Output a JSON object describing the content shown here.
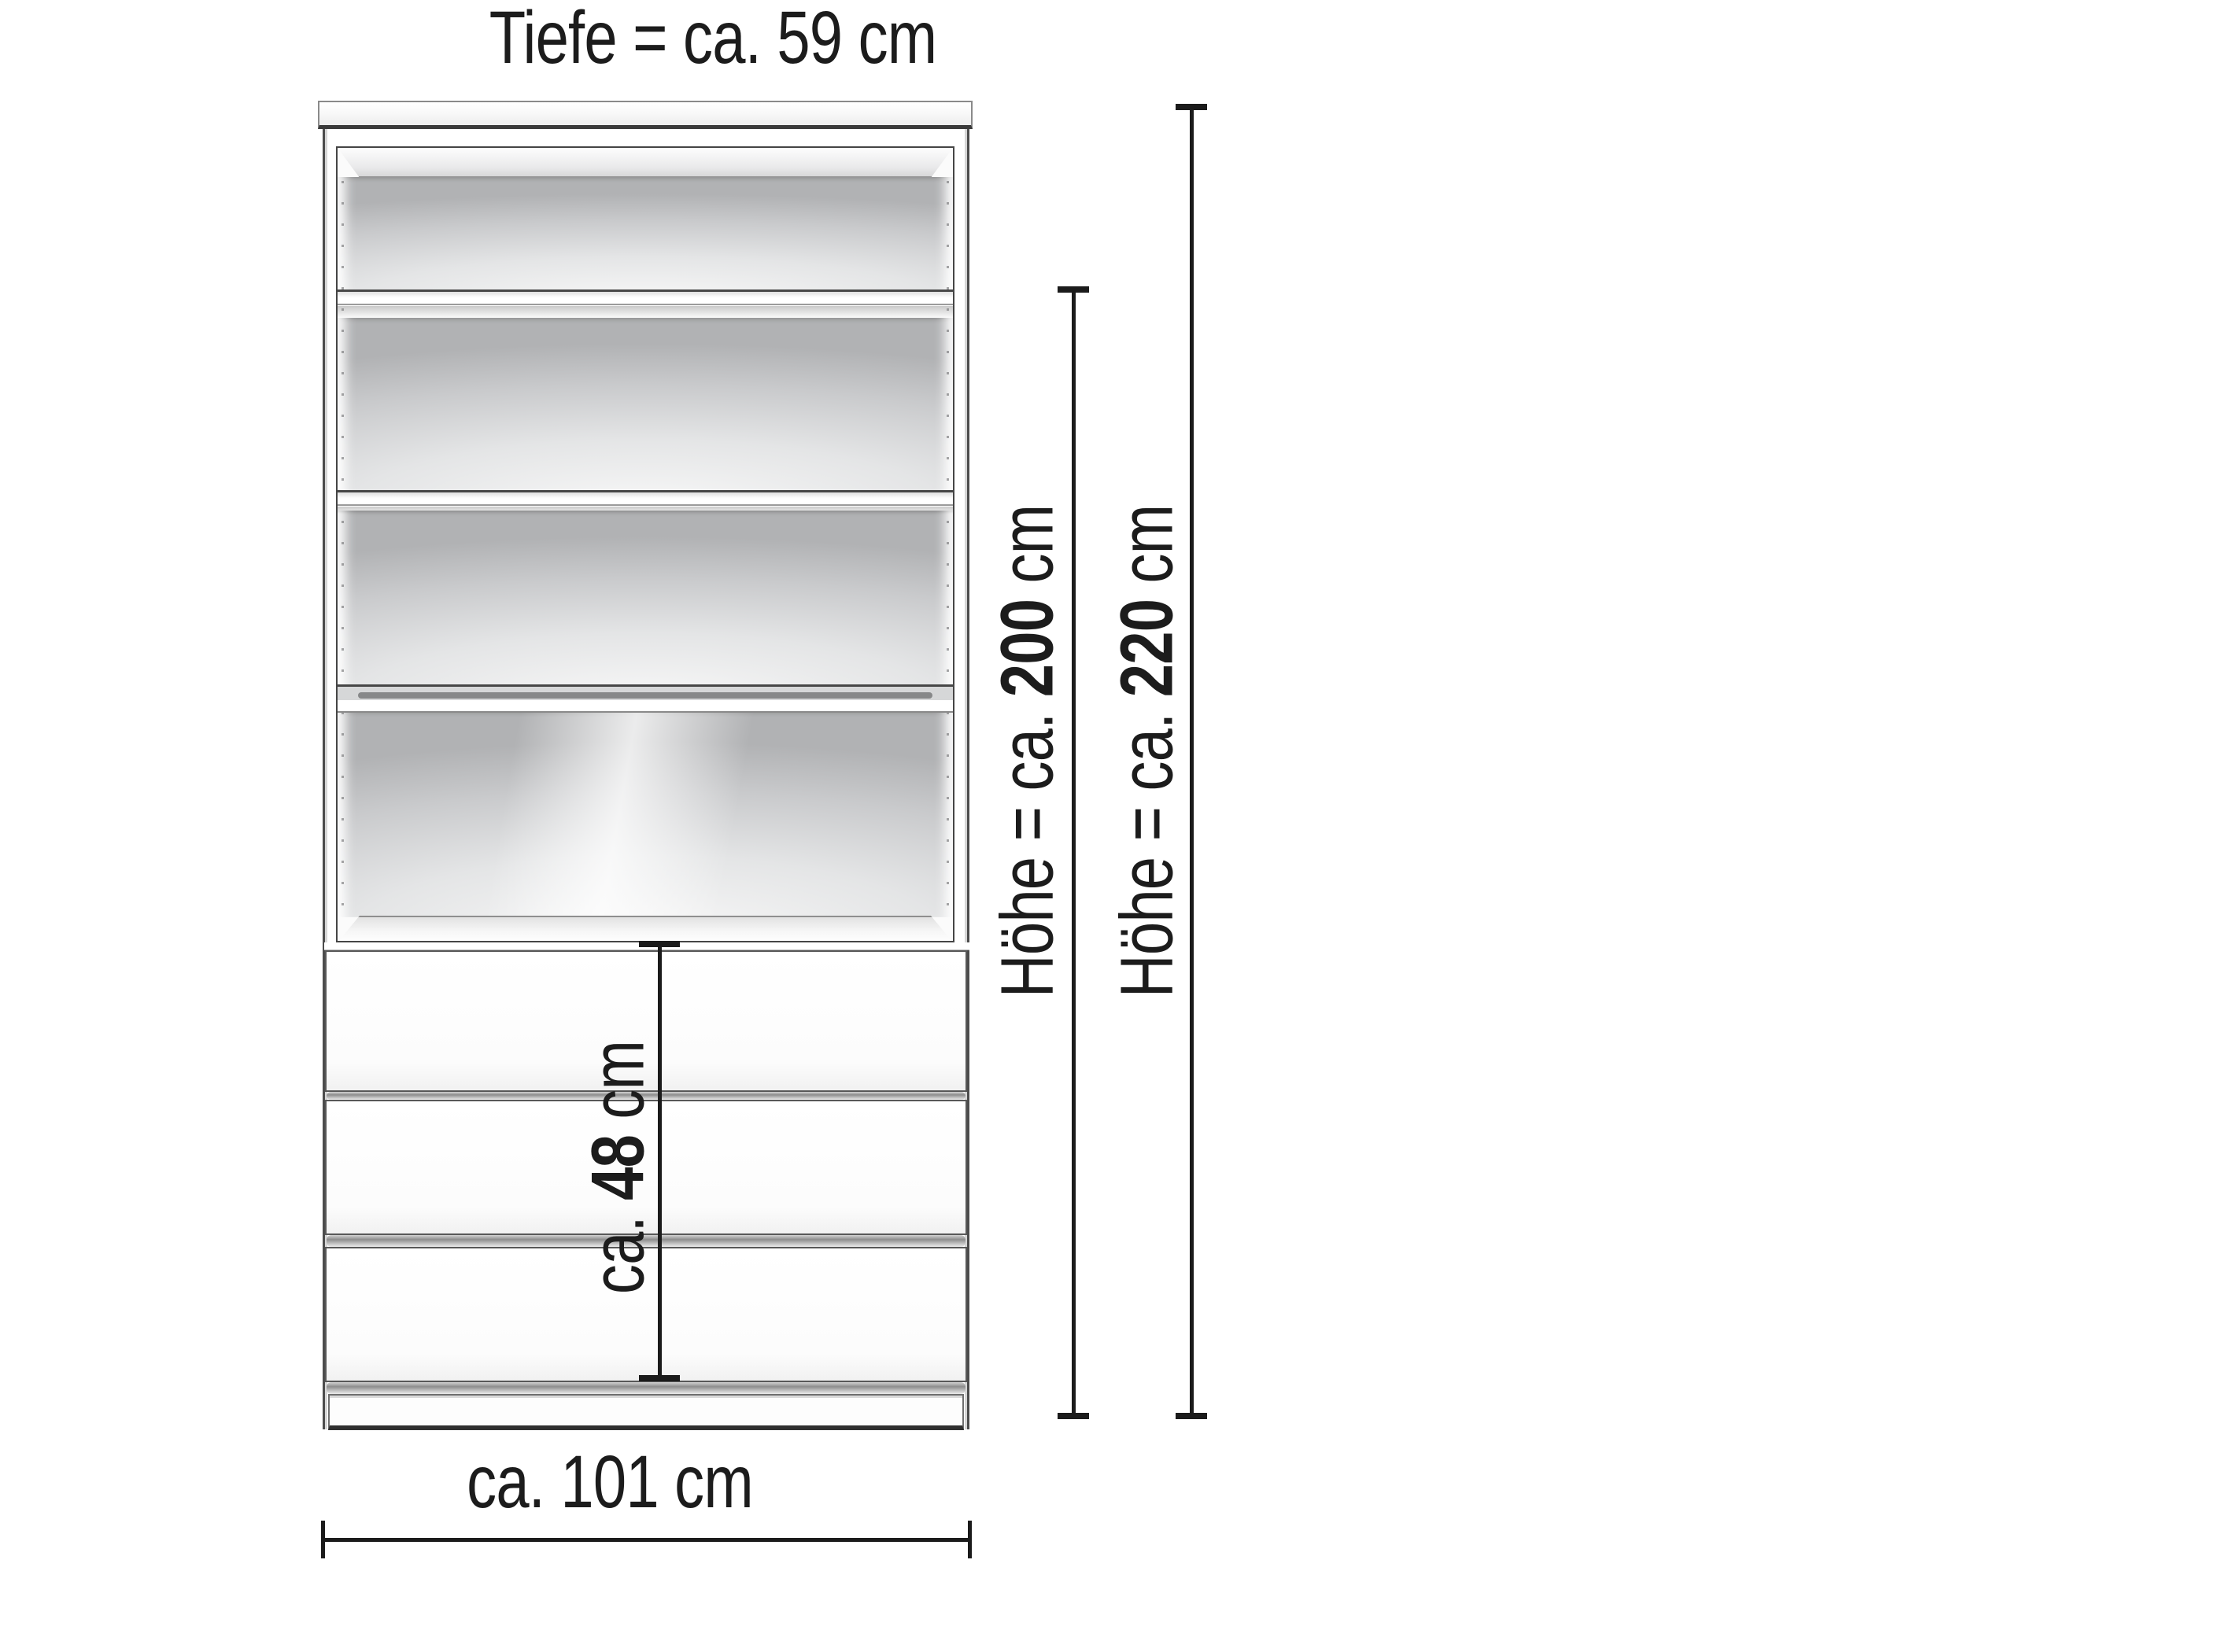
{
  "diagram": {
    "type": "furniture-dimension-drawing",
    "subject": "wardrobe shelf unit with 4 open compartments and 3 drawers",
    "ink_color": "#1b1b1b",
    "panel_color": "#ffffff",
    "back_panel_gray": "#c9cacc"
  },
  "labels": {
    "depth": {
      "prefix": "Tiefe = ca. ",
      "value": "59",
      "suffix": " cm"
    },
    "height_inner": {
      "prefix": "Höhe = ca. ",
      "value": "200",
      "suffix": " cm"
    },
    "height_outer": {
      "prefix": "Höhe = ca. ",
      "value": "220",
      "suffix": " cm"
    },
    "drawer_section": {
      "prefix": "ca. ",
      "value": "48",
      "suffix": " cm"
    },
    "width": {
      "prefix": "ca. ",
      "value": "101",
      "suffix": " cm"
    }
  }
}
